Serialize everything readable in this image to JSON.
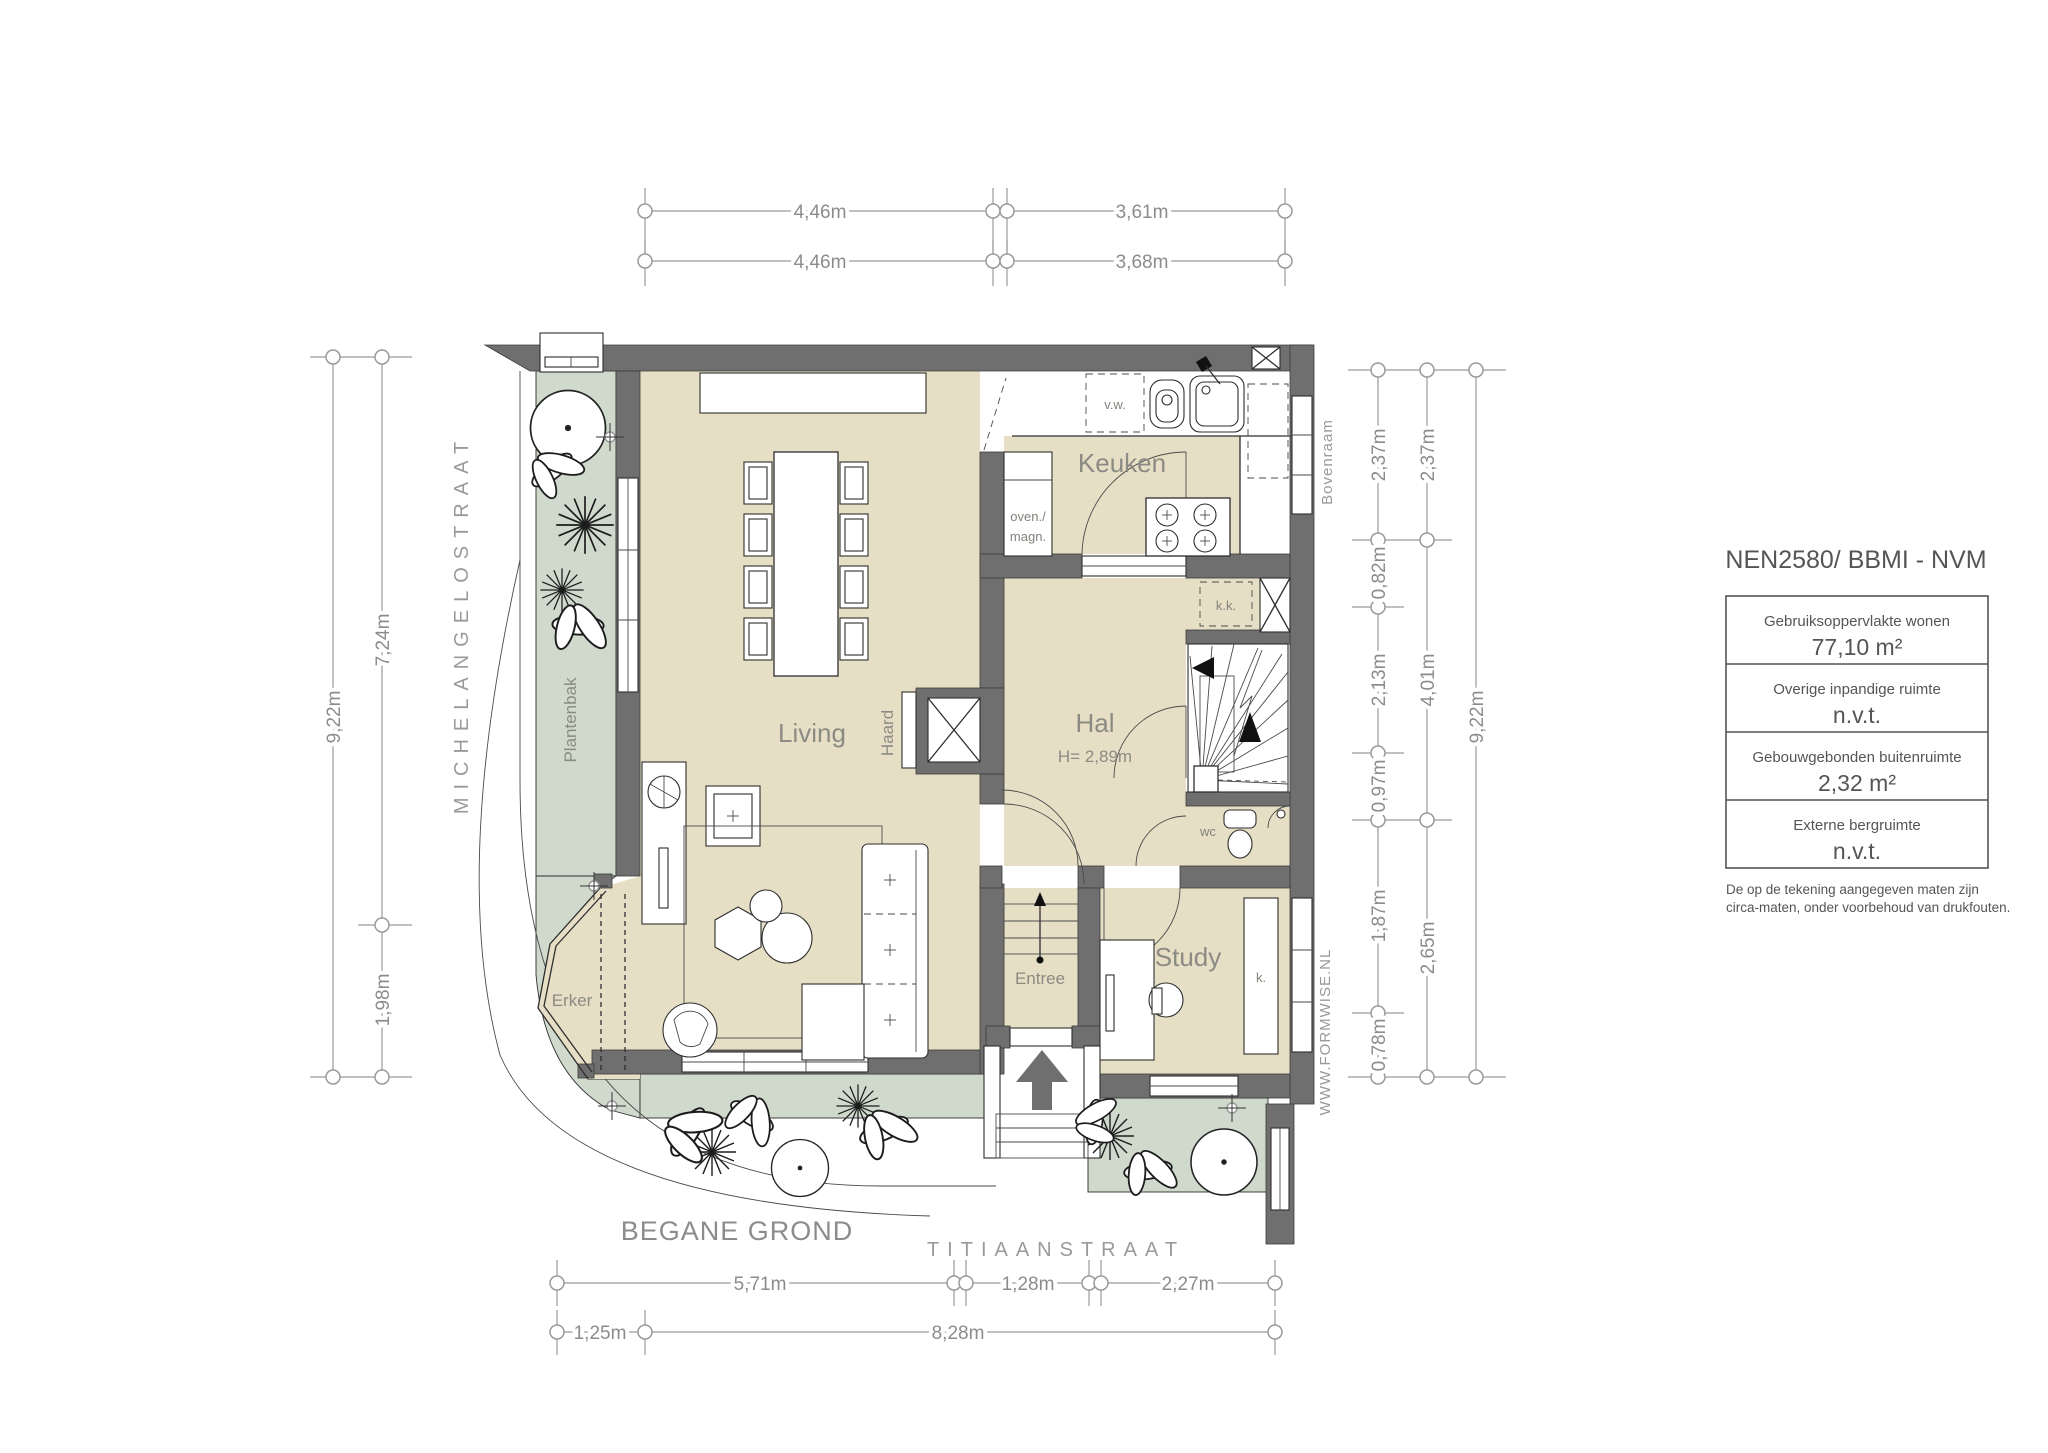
{
  "floor_title": "BEGANE GROND",
  "streets": {
    "left": "MICHELANGELOSTRAAT",
    "bottom": "TITIAANSTRAAT"
  },
  "watermark": "WWW.FORMWISE.NL",
  "rooms": {
    "living": "Living",
    "keuken": "Keuken",
    "hal": "Hal",
    "hal_height": "H= 2,89m",
    "study": "Study",
    "entree": "Entree",
    "erker": "Erker"
  },
  "features": {
    "haard": "Haard",
    "plantenbak": "Plantenbak",
    "bovenraam": "Bovenraam",
    "dishwasher": "v.w.",
    "oven_line1": "oven./",
    "oven_line2": "magn.",
    "fridge": "k.k.",
    "wc": "wc",
    "closet": "k."
  },
  "dims": {
    "top1": [
      "4,46m",
      "3,61m"
    ],
    "top2": [
      "4,46m",
      "3,68m"
    ],
    "left": [
      "9,22m",
      "7,24m",
      "1,98m"
    ],
    "right_inner": [
      "2,37m",
      "0,82m",
      "2,13m",
      "0,97m",
      "1,87m",
      "0,78m"
    ],
    "right_mid": [
      "2,37m",
      "4,01m",
      "2,65m"
    ],
    "right_outer": "9,22m",
    "bottom1": [
      "5,71m",
      "1,28m",
      "2,27m"
    ],
    "bottom2": [
      "1,25m",
      "8,28m"
    ]
  },
  "info_panel": {
    "title": "NEN2580/ BBMI - NVM",
    "rows": [
      {
        "label": "Gebruiksoppervlakte wonen",
        "value": "77,10 m²"
      },
      {
        "label": "Overige inpandige ruimte",
        "value": "n.v.t."
      },
      {
        "label": "Gebouwgebonden buitenruimte",
        "value": "2,32 m²"
      },
      {
        "label": "Externe bergruimte",
        "value": "n.v.t."
      }
    ],
    "disclaimer": [
      "De op de tekening aangegeven maten zijn",
      "circa-maten, onder voorbehoud van drukfouten."
    ]
  },
  "colors": {
    "wall": "#6f6f6f",
    "floor": "#e7dfc5",
    "garden": "#cfdacc",
    "dim": "#9a9a9a",
    "label": "#8b8b84",
    "panel_text": "#555555",
    "line": "#2e2e2e",
    "arrow": "#6f6f6f"
  }
}
